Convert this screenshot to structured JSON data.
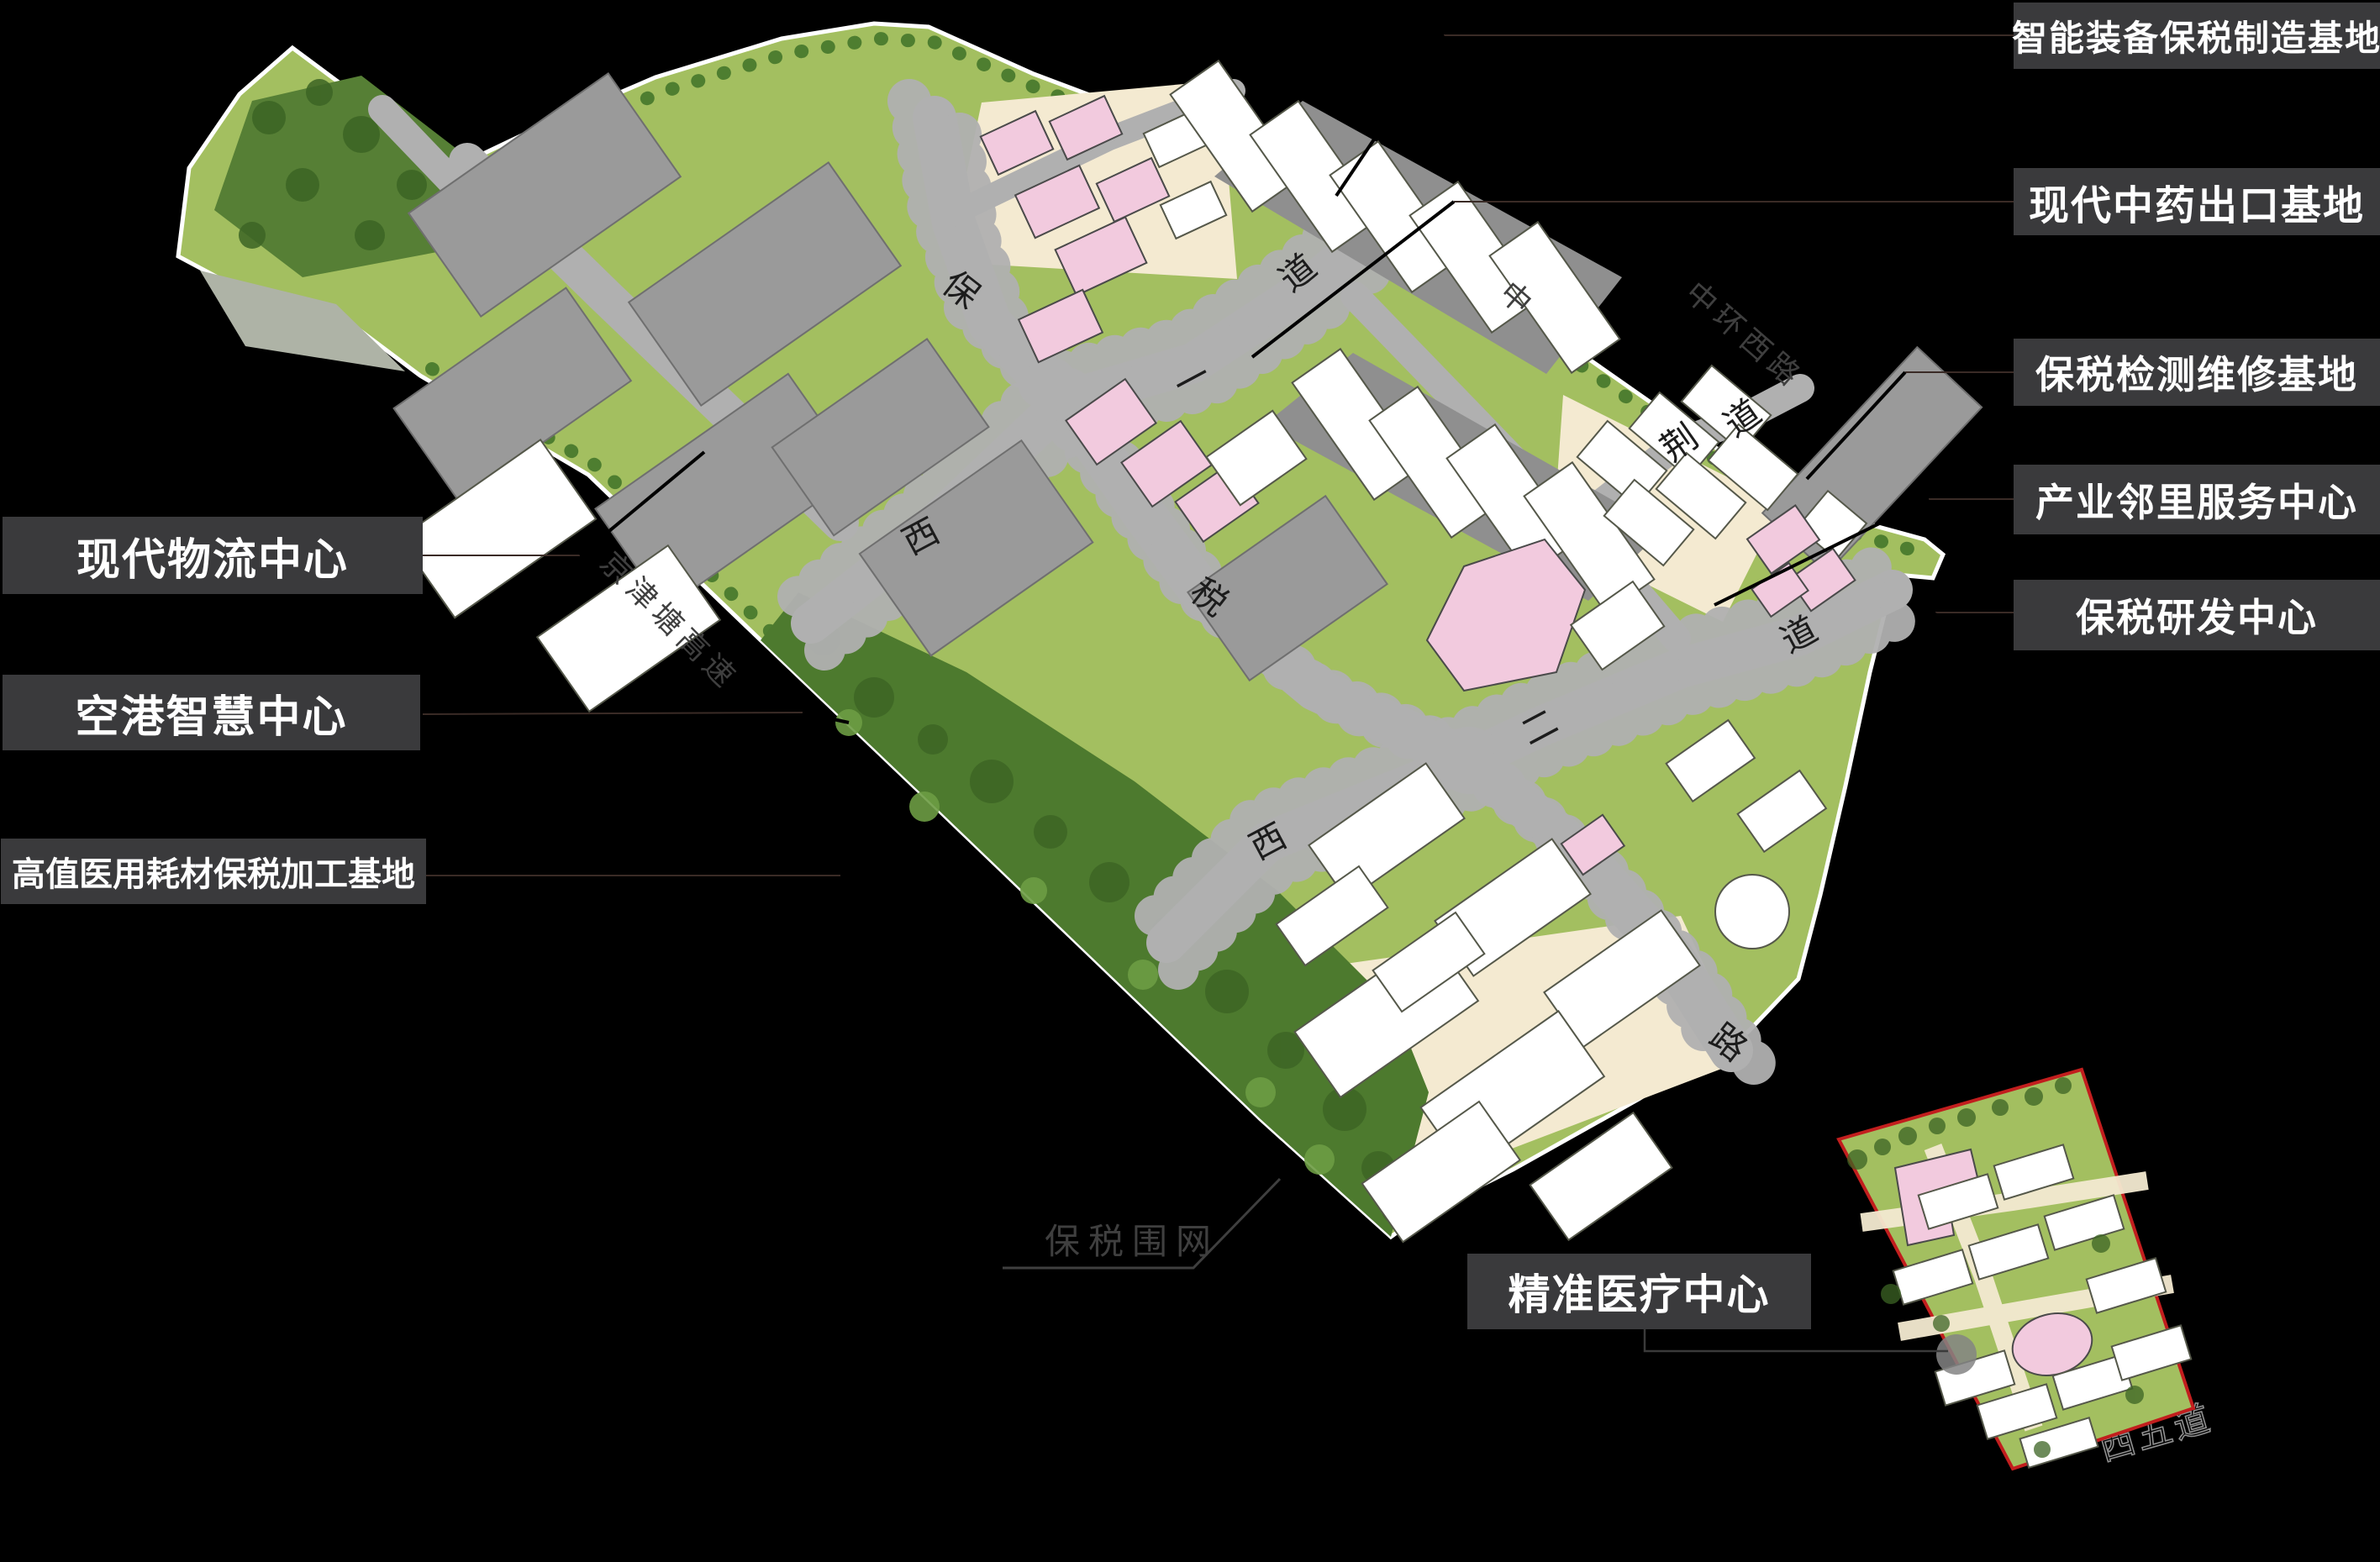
{
  "callouts": [
    {
      "id": "intelligent-equipment",
      "label": "智能装备保税制造基地"
    },
    {
      "id": "tcm-export",
      "label": "现代中药出口基地"
    },
    {
      "id": "bonded-testing",
      "label": "保税检测维修基地"
    },
    {
      "id": "neighborhood-service",
      "label": "产业邻里服务中心"
    },
    {
      "id": "bonded-rd",
      "label": "保税研发中心"
    },
    {
      "id": "modern-logistics",
      "label": "现代物流中心"
    },
    {
      "id": "airport-smart",
      "label": "空港智慧中心"
    },
    {
      "id": "medical-consumables",
      "label": "高值医用耗材保税加工基地"
    },
    {
      "id": "precision-medical",
      "label": "精准医疗中心"
    }
  ],
  "map": {
    "fence_label": "保税围网",
    "roads": {
      "spine": [
        "保",
        "税",
        "路"
      ],
      "west_one": [
        "西",
        "一",
        "道"
      ],
      "west_two": [
        "西",
        "二",
        "道"
      ],
      "northeast": [
        "荆",
        "道"
      ]
    },
    "outside": {
      "expressway": "京津塘高速",
      "ring_road": "中环西路",
      "ring_road_char": "中",
      "west_five": "西五道"
    }
  },
  "colors": {
    "background": "#000000",
    "callout_box": "#3a3a3c",
    "callout_text": "#ffffff",
    "site_grass": "#a3bf60",
    "forest": "#4d7a2e",
    "road_gray": "#b0b0b0",
    "warehouse_gray": "#9a9a9a",
    "building_white": "#ffffff",
    "building_pink": "#f2cade",
    "yard_cream": "#f4ead1",
    "parcel_border_red": "#c21e1e",
    "fence_label_gray": "#3f3f3f"
  }
}
